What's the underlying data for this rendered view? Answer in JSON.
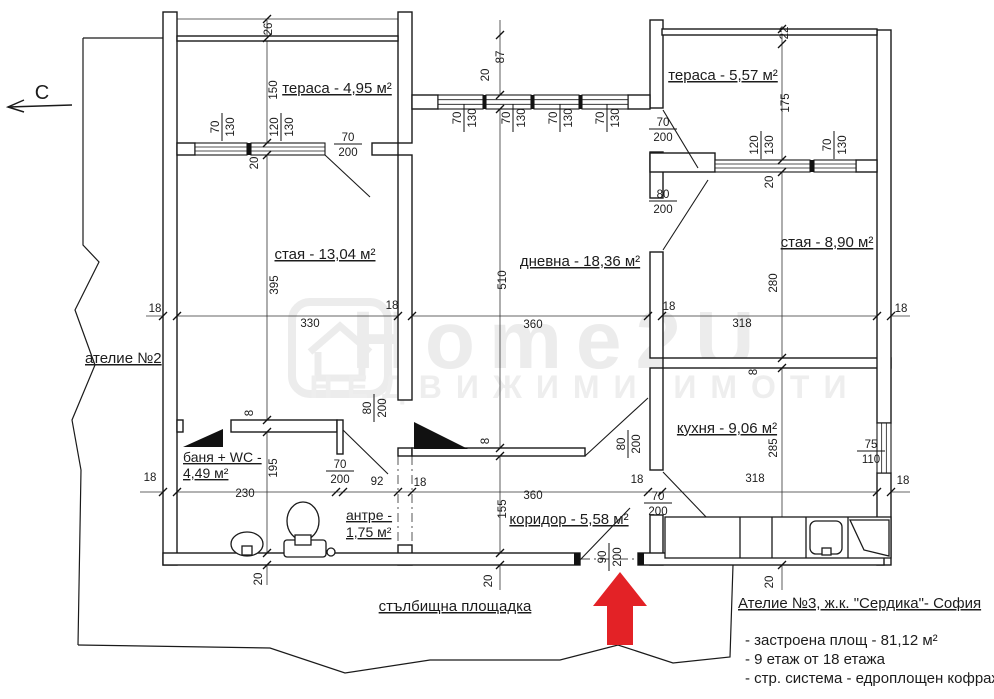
{
  "north": {
    "label": "С"
  },
  "watermark": {
    "line1": "Home2U",
    "line2": "НЕДВИЖИМИ ИМОТИ"
  },
  "colors": {
    "entrance_arrow": "#e32226",
    "line": "#1a1a1a"
  },
  "rooms": {
    "terrace_left": {
      "label": "тераса - 4,95 м²"
    },
    "terrace_right": {
      "label": "тераса - 5,57 м²"
    },
    "room_left": {
      "label": "стая - 13,04 м²"
    },
    "living": {
      "label": "дневна - 18,36 м²"
    },
    "room_right": {
      "label": "стая - 8,90 м²"
    },
    "kitchen": {
      "label": "кухня - 9,06 м²"
    },
    "bath": {
      "label1": "баня + WC -",
      "label2": "4,49 м²"
    },
    "hall": {
      "label1": "антре -",
      "label2": "1,75 м²"
    },
    "corridor": {
      "label": "коридор - 5,58 м²"
    },
    "atelier2": {
      "label": "ателие №2"
    },
    "stairwell": {
      "label": "стълбищна площадка"
    }
  },
  "info": {
    "title": "Ателие №3, ж.к. \"Сердика\"- София",
    "line1": "- застроена площ - 81,12 м²",
    "line2": "- 9 етаж от 18 етажа",
    "line3": "- стр. система - едроплощен кофраж"
  },
  "dim_labels": [
    {
      "t": "26",
      "x": 272,
      "y": 29,
      "r": -90
    },
    {
      "t": "150",
      "x": 277,
      "y": 90,
      "r": -90
    },
    {
      "t": "20",
      "x": 258,
      "y": 163,
      "r": -90
    },
    {
      "t": "87",
      "x": 504,
      "y": 57,
      "r": -90
    },
    {
      "t": "20",
      "x": 489,
      "y": 75,
      "r": -90
    },
    {
      "t": "22",
      "x": 788,
      "y": 33,
      "r": -90
    },
    {
      "t": "175",
      "x": 789,
      "y": 103,
      "r": -90
    },
    {
      "t": "20",
      "x": 773,
      "y": 182,
      "r": -90
    },
    {
      "t": "18",
      "x": 155,
      "y": 312,
      "r": 0
    },
    {
      "t": "330",
      "x": 310,
      "y": 327,
      "r": 0
    },
    {
      "t": "395",
      "x": 278,
      "y": 285,
      "r": -90
    },
    {
      "t": "18",
      "x": 392,
      "y": 309,
      "r": 0
    },
    {
      "t": "360",
      "x": 533,
      "y": 328,
      "r": 0
    },
    {
      "t": "510",
      "x": 506,
      "y": 280,
      "r": -90
    },
    {
      "t": "18",
      "x": 669,
      "y": 310,
      "r": 0
    },
    {
      "t": "318",
      "x": 742,
      "y": 327,
      "r": 0
    },
    {
      "t": "280",
      "x": 777,
      "y": 283,
      "r": -90
    },
    {
      "t": "18",
      "x": 901,
      "y": 312,
      "r": 0
    },
    {
      "t": "8",
      "x": 253,
      "y": 413,
      "r": -90
    },
    {
      "t": "8",
      "x": 489,
      "y": 441,
      "r": -90
    },
    {
      "t": "8",
      "x": 757,
      "y": 372,
      "r": -90
    },
    {
      "t": "18",
      "x": 150,
      "y": 481,
      "r": 0
    },
    {
      "t": "230",
      "x": 245,
      "y": 497,
      "r": 0
    },
    {
      "t": "195",
      "x": 277,
      "y": 468,
      "r": -90
    },
    {
      "t": "92",
      "x": 377,
      "y": 485,
      "r": 0
    },
    {
      "t": "18",
      "x": 420,
      "y": 486,
      "r": 0
    },
    {
      "t": "360",
      "x": 533,
      "y": 499,
      "r": 0
    },
    {
      "t": "155",
      "x": 506,
      "y": 509,
      "r": -90
    },
    {
      "t": "18",
      "x": 637,
      "y": 483,
      "r": 0
    },
    {
      "t": "318",
      "x": 755,
      "y": 482,
      "r": 0
    },
    {
      "t": "285",
      "x": 777,
      "y": 448,
      "r": -90
    },
    {
      "t": "18",
      "x": 903,
      "y": 484,
      "r": 0
    },
    {
      "t": "20",
      "x": 262,
      "y": 579,
      "r": -90
    },
    {
      "t": "20",
      "x": 492,
      "y": 581,
      "r": -90
    },
    {
      "t": "20",
      "x": 773,
      "y": 582,
      "r": -90
    }
  ],
  "dim_fractions": [
    {
      "n": "70",
      "d": "130",
      "x": 222,
      "y": 127,
      "r": -90
    },
    {
      "n": "120",
      "d": "130",
      "x": 281,
      "y": 127,
      "r": -90
    },
    {
      "n": "70",
      "d": "200",
      "x": 348,
      "y": 144,
      "r": 0
    },
    {
      "n": "70",
      "d": "130",
      "x": 464,
      "y": 118,
      "r": -90
    },
    {
      "n": "70",
      "d": "130",
      "x": 513,
      "y": 118,
      "r": -90
    },
    {
      "n": "70",
      "d": "130",
      "x": 560,
      "y": 118,
      "r": -90
    },
    {
      "n": "70",
      "d": "130",
      "x": 607,
      "y": 118,
      "r": -90
    },
    {
      "n": "70",
      "d": "200",
      "x": 663,
      "y": 129,
      "r": 0
    },
    {
      "n": "120",
      "d": "130",
      "x": 761,
      "y": 145,
      "r": -90
    },
    {
      "n": "70",
      "d": "130",
      "x": 834,
      "y": 145,
      "r": -90
    },
    {
      "n": "80",
      "d": "200",
      "x": 663,
      "y": 201,
      "r": 0
    },
    {
      "n": "80",
      "d": "200",
      "x": 374,
      "y": 408,
      "r": -90
    },
    {
      "n": "80",
      "d": "200",
      "x": 628,
      "y": 444,
      "r": -90
    },
    {
      "n": "70",
      "d": "200",
      "x": 340,
      "y": 471,
      "r": 0
    },
    {
      "n": "70",
      "d": "200",
      "x": 658,
      "y": 503,
      "r": 0
    },
    {
      "n": "90",
      "d": "200",
      "x": 609,
      "y": 557,
      "r": -90
    },
    {
      "n": "75",
      "d": "110",
      "x": 871,
      "y": 451,
      "r": 0
    }
  ]
}
